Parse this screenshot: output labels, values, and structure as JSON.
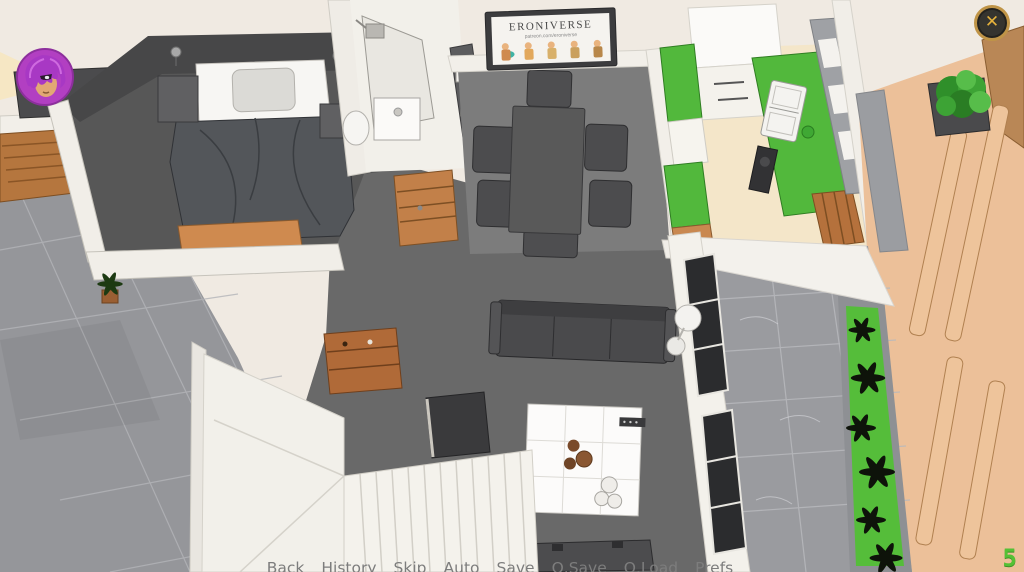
{
  "ui": {
    "quick_menu": {
      "items": [
        "Back",
        "History",
        "Skip",
        "Auto",
        "Save",
        "Q.Save",
        "Q.Load",
        "Prefs"
      ],
      "text_color": "#7d7d7d"
    },
    "close_button": {
      "glyph": "✕",
      "ring_color": "#bf9447",
      "glyph_color": "#e6b23c"
    },
    "counter": {
      "value": "5",
      "color": "#54c135"
    },
    "avatar": {
      "icon": "purple-hair-girl-avatar-icon",
      "ring_color": "#b23fc2"
    }
  },
  "scene": {
    "poster": {
      "title": "ERONIVERSE",
      "subtitle": "patreon.com/eroniverse"
    },
    "palette": {
      "kitchen_counter_green": "#52b83c",
      "planter_green": "#55bd3a",
      "terrace_tan": "#ecc099",
      "exterior_tile_gray": "#95969a",
      "interior_floor_gray": "#696969",
      "bedroom_wall_dark": "#474748",
      "wood_accent": "#c28049"
    }
  }
}
